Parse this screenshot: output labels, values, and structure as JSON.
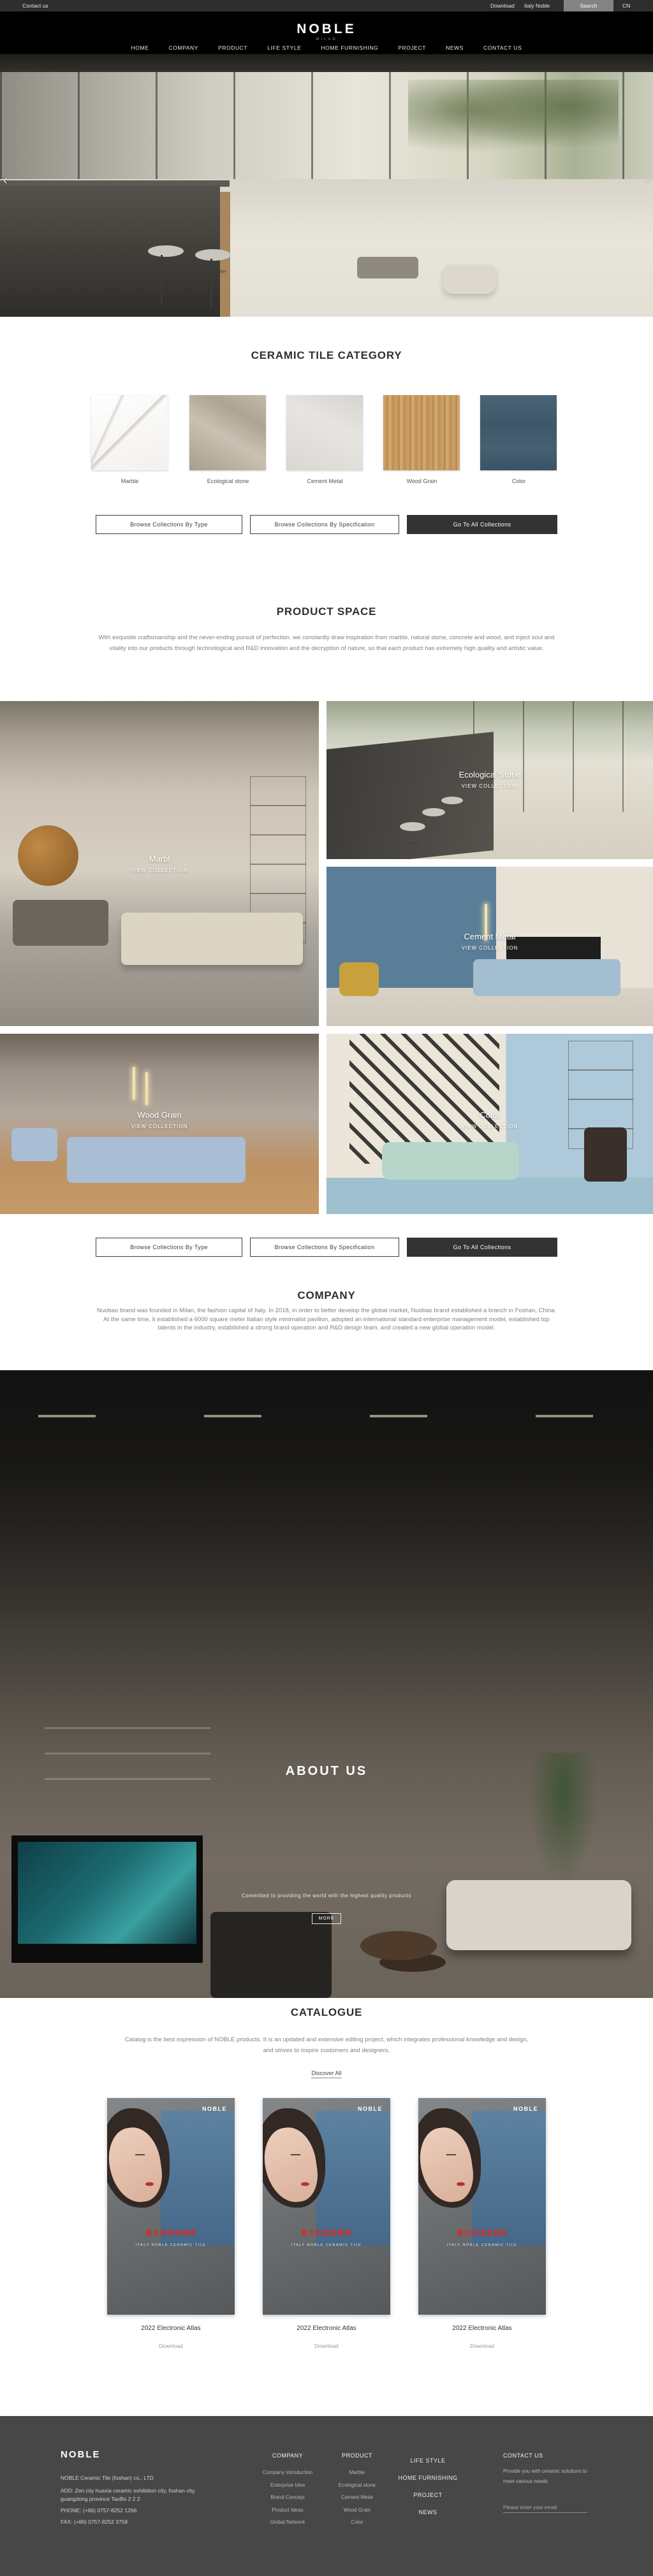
{
  "topbar": {
    "contact_us": "Contact us",
    "download": "Download",
    "italy_noble": "Italy Noble",
    "search": "Search",
    "lang": "CN"
  },
  "header": {
    "logo": "NOBLE",
    "logo_sub": "MILAN",
    "nav": [
      "HOME",
      "COMPANY",
      "PRODUCT",
      "LIFE STYLE",
      "HOME FURNISHING",
      "PROJECT",
      "NEWS",
      "CONTACT US"
    ]
  },
  "hero": {
    "prev": "‹",
    "next": "›"
  },
  "category": {
    "title": "CERAMIC TILE CATEGORY",
    "items": [
      {
        "label": "Marble"
      },
      {
        "label": "Ecological stone"
      },
      {
        "label": "Cement Metal"
      },
      {
        "label": "Wood Grain"
      },
      {
        "label": "Color"
      }
    ]
  },
  "collection_buttons": {
    "by_type": "Browse Collections By Type",
    "by_spec": "Browse Collections By Specification",
    "all": "Go To All Collections"
  },
  "product_space": {
    "title": "PRODUCT SPACE",
    "paragraph": "With exquisite craftsmanship and the never-ending pursuit of perfection, we constantly draw inspiration from marble, natural stone, concrete and wood, and inject soul and vitality into our products through technological and R&D innovation and the decryption of nature, so that each product has extremely high quality and artistic value.",
    "spaces": [
      {
        "name": "Marbl",
        "cta": "VIEW COLLECTION"
      },
      {
        "name": "Ecological Stone",
        "cta": "VIEW COLLECTION"
      },
      {
        "name": "Cement Metal",
        "cta": "VIEW COLLECTION"
      },
      {
        "name": "Wood Grain",
        "cta": "VIEW COLLECTION"
      },
      {
        "name": "Color",
        "cta": "VIEW COLLECTION"
      }
    ]
  },
  "company": {
    "title": "COMPANY",
    "paragraph": "Nuobao brand was founded in Milan, the fashion capital of Italy. In 2018, in order to better develop the global market, Nuobao brand established a branch in Foshan, China. At the same time, it established a 6000 square meter Italian style minimalist pavilion, adopted an international standard enterprise management model, established top talents in the industry, established a strong brand operation and R&D design team, and created a new global operation model."
  },
  "about": {
    "title": "ABOUT US",
    "tagline": "Committed to providing the world with the highest quality products",
    "button": "MORE"
  },
  "catalogue": {
    "title": "CATALOGUE",
    "paragraph": "Catalog is the best expression of NOBLE products. It is an updated and extensive editing project, which integrates professional knowledge and design, and strives to inspire customers and designers.",
    "discover": "Discover All",
    "cover_brand": "NOBLE",
    "cover_title": "意大利诺宝瓷砖",
    "cover_sub": "ITALY NOBLE CERAMIC TILE",
    "items": [
      {
        "caption": "2022 Electronic Atlas",
        "download": "Download"
      },
      {
        "caption": "2022 Electronic Atlas",
        "download": "Download"
      },
      {
        "caption": "2022 Electronic Atlas",
        "download": "Download"
      }
    ]
  },
  "footer": {
    "logo": "NOBLE",
    "company_name": "NOBLE Ceramic Tile (foshan) co., LTD",
    "address": "ADD:  Zen city huaxia ceramic exhibition city, foshan city, guangdong province TaoBo 2 2 2",
    "phone": "PHONE:   (+86)  0757-8252 1266",
    "fax": "FAX:   (+86)  0757-8252 3758",
    "col_company": {
      "header": "COMPANY",
      "items": [
        "Company Introduction",
        "Enterprise Idea",
        "Brand Concept",
        "Product Ideas",
        "Global Network"
      ]
    },
    "col_product": {
      "header": "PRODUCT",
      "items": [
        "Marble",
        "Ecological stone",
        "Cement Metal",
        "Wood Grain",
        "Color"
      ]
    },
    "col_nav": [
      "LIFE STYLE",
      "HOME FURNISHING",
      "PROJECT",
      "NEWS"
    ],
    "contact": {
      "header": "CONTACT US",
      "text": "Provide you with ceramic solutions to meet various needs",
      "email_placeholder": "Please enter your email"
    }
  }
}
